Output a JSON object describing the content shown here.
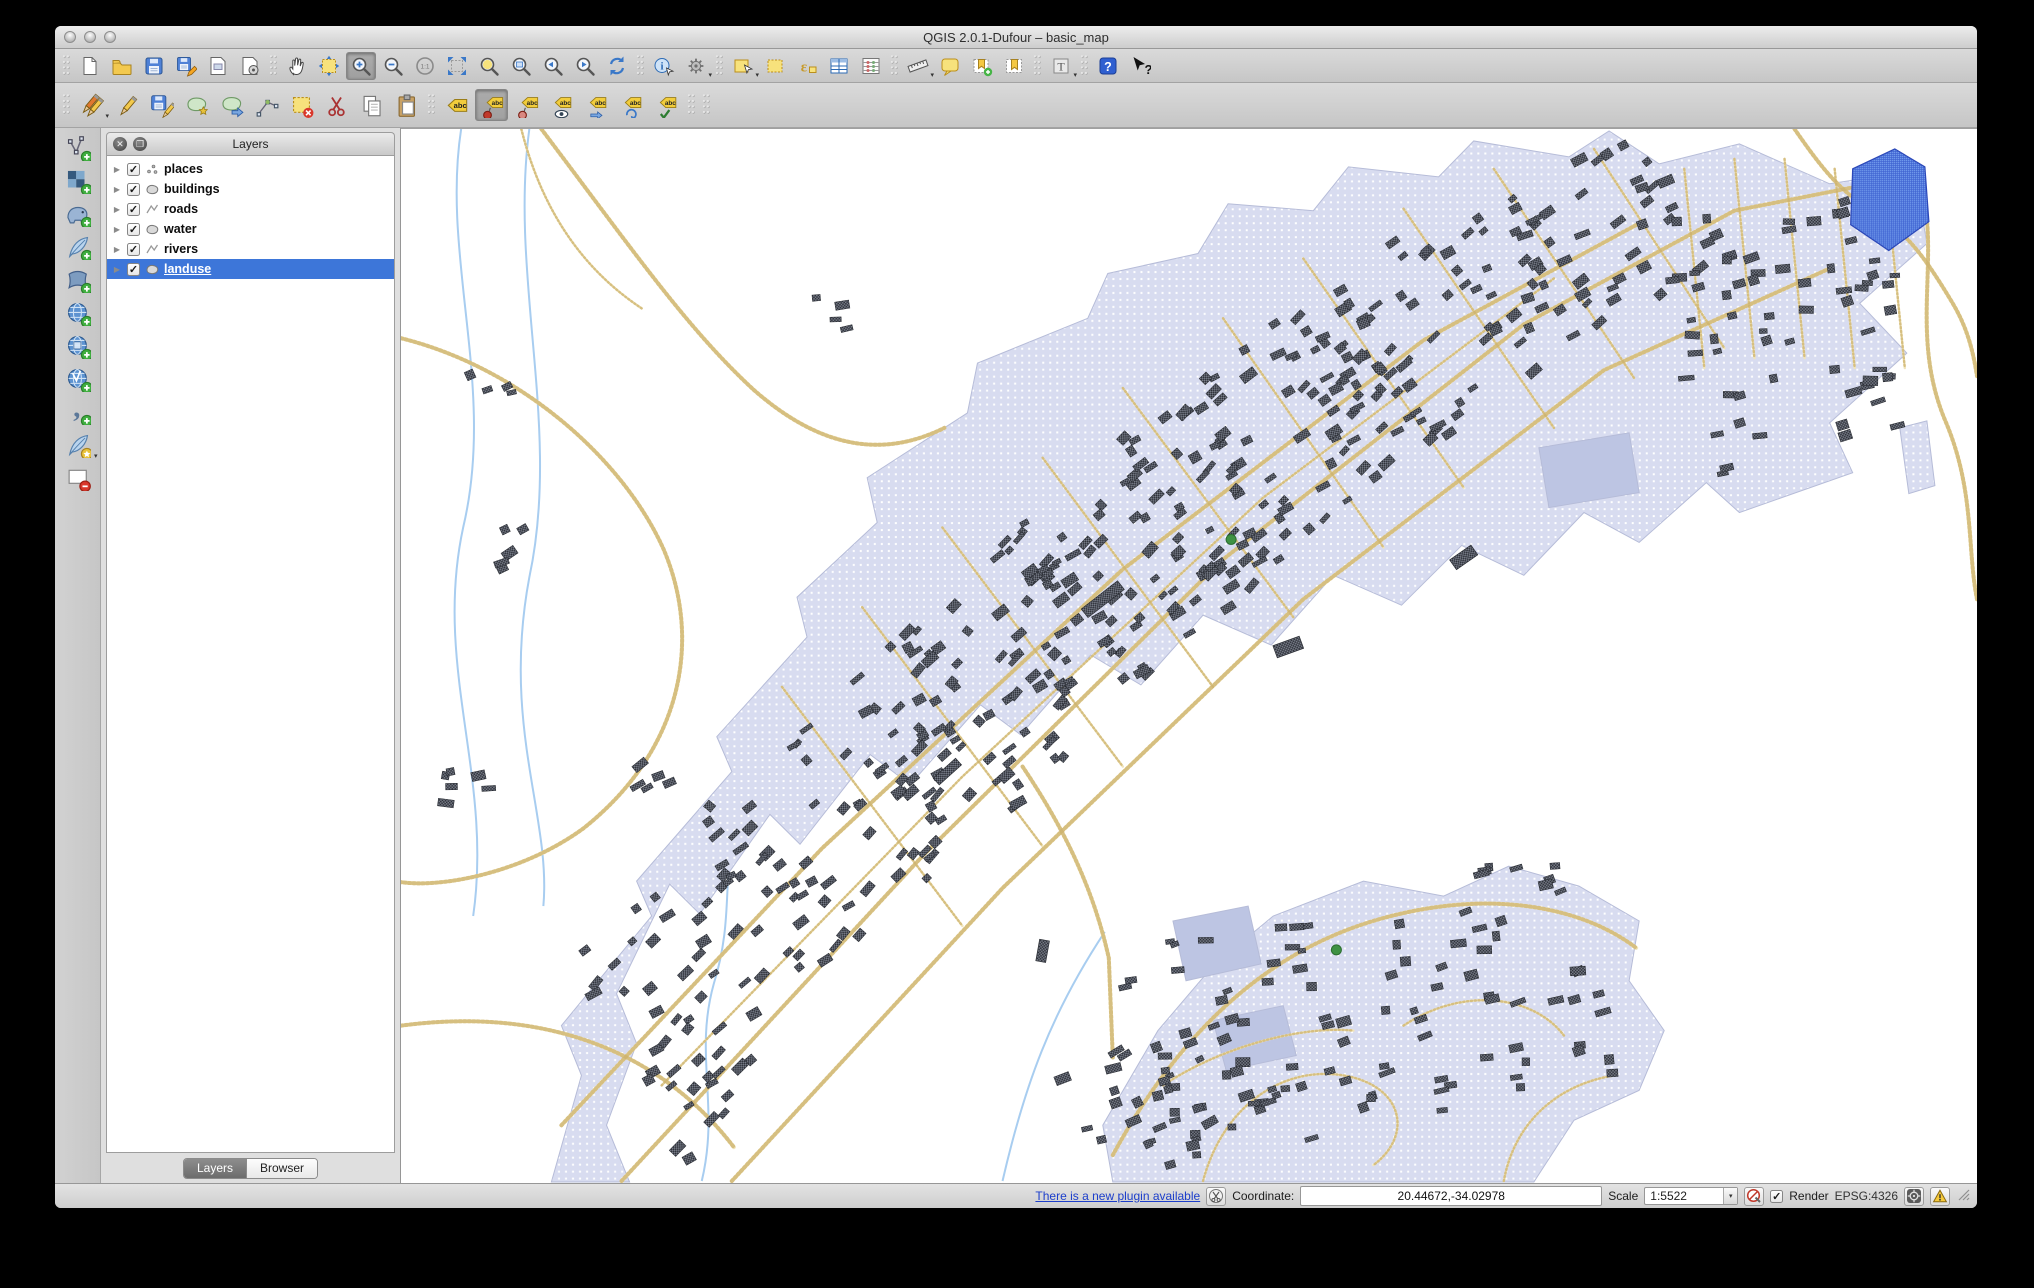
{
  "window": {
    "title": "QGIS 2.0.1-Dufour – basic_map"
  },
  "titlebar_buttons": [
    "close-button",
    "minimize-button",
    "zoom-button"
  ],
  "toolbars": {
    "main": [
      {
        "type": "grip"
      },
      {
        "name": "new-project",
        "icon": "doc"
      },
      {
        "name": "open-project",
        "icon": "folder"
      },
      {
        "name": "save-project",
        "icon": "save"
      },
      {
        "name": "save-project-as",
        "icon": "save-as"
      },
      {
        "name": "new-print-composer",
        "icon": "composer"
      },
      {
        "name": "composer-manager",
        "icon": "composer-mgr"
      },
      {
        "type": "grip"
      },
      {
        "name": "pan-map",
        "icon": "pan"
      },
      {
        "name": "pan-to-selection",
        "icon": "pan-sel"
      },
      {
        "name": "zoom-in",
        "icon": "zoom-in",
        "pressed": true
      },
      {
        "name": "zoom-out",
        "icon": "zoom-out"
      },
      {
        "name": "zoom-native",
        "icon": "zoom-11"
      },
      {
        "name": "zoom-full",
        "icon": "zoom-full"
      },
      {
        "name": "zoom-to-selection",
        "icon": "zoom-sel"
      },
      {
        "name": "zoom-to-layer",
        "icon": "zoom-layer"
      },
      {
        "name": "zoom-last",
        "icon": "zoom-last"
      },
      {
        "name": "zoom-next",
        "icon": "zoom-next"
      },
      {
        "name": "refresh-map",
        "icon": "refresh"
      },
      {
        "type": "grip"
      },
      {
        "name": "identify-features",
        "icon": "identify"
      },
      {
        "name": "run-feature-action",
        "icon": "gear",
        "dropdown": true
      },
      {
        "type": "grip"
      },
      {
        "name": "select-features",
        "icon": "select-rect",
        "dropdown": true
      },
      {
        "name": "deselect-features",
        "icon": "deselect"
      },
      {
        "name": "select-by-expression",
        "icon": "expression"
      },
      {
        "name": "open-attribute-table",
        "icon": "attr-table"
      },
      {
        "name": "field-calculator",
        "icon": "stats"
      },
      {
        "type": "grip"
      },
      {
        "name": "measure-line",
        "icon": "measure",
        "dropdown": true
      },
      {
        "name": "map-tips",
        "icon": "maptips"
      },
      {
        "name": "new-bookmark",
        "icon": "bookmark-new"
      },
      {
        "name": "show-bookmarks",
        "icon": "bookmark-show"
      },
      {
        "type": "grip"
      },
      {
        "name": "text-annotation",
        "icon": "annotation",
        "dropdown": true
      },
      {
        "type": "grip"
      },
      {
        "name": "help-contents",
        "icon": "help"
      },
      {
        "name": "whats-this",
        "icon": "whatsthis"
      }
    ],
    "edit": [
      {
        "type": "grip"
      },
      {
        "name": "current-edits",
        "icon": "edits-current",
        "dropdown": true
      },
      {
        "name": "toggle-editing",
        "icon": "edit-toggle"
      },
      {
        "name": "save-layer-edits",
        "icon": "edits-save"
      },
      {
        "name": "add-feature",
        "icon": "feat-add"
      },
      {
        "name": "move-feature",
        "icon": "feat-move"
      },
      {
        "name": "node-tool",
        "icon": "node"
      },
      {
        "name": "delete-selected",
        "icon": "del-sel"
      },
      {
        "name": "cut-features",
        "icon": "cut"
      },
      {
        "name": "copy-features",
        "icon": "copy"
      },
      {
        "name": "paste-features",
        "icon": "paste"
      },
      {
        "type": "grip"
      },
      {
        "name": "layer-labeling-options",
        "icon": "label-abc"
      },
      {
        "name": "pin-unpin-labels",
        "icon": "label-pin",
        "pressed": true
      },
      {
        "name": "highlight-pinned-labels",
        "icon": "label-pin2"
      },
      {
        "name": "show-hide-labels",
        "icon": "label-eye"
      },
      {
        "name": "move-label",
        "icon": "label-move"
      },
      {
        "name": "rotate-label",
        "icon": "label-rotate"
      },
      {
        "name": "change-label-properties",
        "icon": "label-props"
      },
      {
        "type": "grip"
      },
      {
        "type": "grip"
      }
    ],
    "side": [
      {
        "name": "add-vector-layer",
        "icon": "vector"
      },
      {
        "name": "add-raster-layer",
        "icon": "raster"
      },
      {
        "name": "add-postgis-layer",
        "icon": "postgis"
      },
      {
        "name": "add-spatialite-layer",
        "icon": "spatialite"
      },
      {
        "name": "add-mssql-layer",
        "icon": "mssql"
      },
      {
        "name": "add-wms-layer",
        "icon": "wms"
      },
      {
        "name": "add-wcs-layer",
        "icon": "wcs"
      },
      {
        "name": "add-wfs-layer",
        "icon": "wfs"
      },
      {
        "name": "add-delimited-text-layer",
        "icon": "delimited"
      },
      {
        "name": "new-spatialite-layer",
        "icon": "sl-new",
        "dropdown": true
      },
      {
        "name": "new-shapefile-layer",
        "icon": "shp-new"
      }
    ]
  },
  "layers_panel": {
    "title": "Layers",
    "header_buttons": [
      "close-panel-button",
      "float-panel-button"
    ],
    "layers": [
      {
        "label": "places",
        "geom": "point",
        "checked": true,
        "selected": false
      },
      {
        "label": "buildings",
        "geom": "polygon",
        "checked": true,
        "selected": false
      },
      {
        "label": "roads",
        "geom": "line",
        "checked": true,
        "selected": false
      },
      {
        "label": "water",
        "geom": "polygon",
        "checked": true,
        "selected": false
      },
      {
        "label": "rivers",
        "geom": "line",
        "checked": true,
        "selected": false
      },
      {
        "label": "landuse",
        "geom": "polygon",
        "checked": true,
        "selected": true
      }
    ],
    "tabs": [
      {
        "label": "Layers",
        "active": true
      },
      {
        "label": "Browser",
        "active": false
      }
    ]
  },
  "status_bar": {
    "plugin_link": "There is a new plugin available",
    "coordinate_label": "Coordinate:",
    "coordinate_value": "20.44672,-34.02978",
    "scale_label": "Scale",
    "scale_value": "1:5522",
    "render_label": "Render",
    "render_checked": true,
    "crs_label": "EPSG:4326",
    "check_glyph": "✓",
    "arrow_glyph": "▾"
  },
  "map": {
    "seed": 42,
    "colors": {
      "background": "#ffffff",
      "landuse_fill": "#d8dcf0",
      "landuse_dot": "#ffffff",
      "landuse_stroke": "#b6bcd8",
      "subpatch_fill": "#bdc5e3",
      "road_base": "#f1e5bb",
      "road_bead": "#ccb26c",
      "river": "#a8cdf0",
      "water_fill": "#7aa4f0",
      "water_line": "#3b5fd0",
      "water_stroke": "#2b48b8",
      "building_dark": "#2f323a",
      "building_light": "#767b87",
      "place_fill": "#3f9243",
      "place_stroke": "#2c6e30"
    },
    "viewbox": [
      1572,
      1058
    ],
    "landuse_polys": [
      [
        [
          150,
          1057
        ],
        [
          180,
          950
        ],
        [
          160,
          900
        ],
        [
          250,
          790
        ],
        [
          235,
          755
        ],
        [
          330,
          645
        ],
        [
          315,
          610
        ],
        [
          405,
          510
        ],
        [
          395,
          470
        ],
        [
          475,
          395
        ],
        [
          465,
          350
        ],
        [
          565,
          285
        ],
        [
          575,
          235
        ],
        [
          685,
          190
        ],
        [
          705,
          145
        ],
        [
          795,
          125
        ],
        [
          825,
          75
        ],
        [
          910,
          82
        ],
        [
          945,
          38
        ],
        [
          1035,
          48
        ],
        [
          1070,
          12
        ],
        [
          1165,
          28
        ],
        [
          1205,
          2
        ],
        [
          1255,
          35
        ],
        [
          1335,
          15
        ],
        [
          1425,
          55
        ],
        [
          1510,
          42
        ],
        [
          1522,
          115
        ],
        [
          1455,
          175
        ],
        [
          1502,
          225
        ],
        [
          1425,
          295
        ],
        [
          1448,
          345
        ],
        [
          1335,
          385
        ],
        [
          1302,
          355
        ],
        [
          1235,
          415
        ],
        [
          1180,
          385
        ],
        [
          1120,
          448
        ],
        [
          1058,
          418
        ],
        [
          998,
          478
        ],
        [
          930,
          448
        ],
        [
          868,
          518
        ],
        [
          800,
          488
        ],
        [
          738,
          558
        ],
        [
          688,
          528
        ],
        [
          618,
          608
        ],
        [
          578,
          578
        ],
        [
          508,
          658
        ],
        [
          468,
          628
        ],
        [
          398,
          718
        ],
        [
          368,
          688
        ],
        [
          298,
          788
        ],
        [
          268,
          758
        ],
        [
          215,
          868
        ],
        [
          235,
          918
        ],
        [
          205,
          1000
        ],
        [
          228,
          1057
        ]
      ],
      [
        [
          710,
          1057
        ],
        [
          700,
          1000
        ],
        [
          755,
          905
        ],
        [
          810,
          840
        ],
        [
          870,
          790
        ],
        [
          960,
          755
        ],
        [
          1040,
          770
        ],
        [
          1105,
          740
        ],
        [
          1175,
          760
        ],
        [
          1235,
          795
        ],
        [
          1225,
          855
        ],
        [
          1260,
          905
        ],
        [
          1235,
          965
        ],
        [
          1170,
          995
        ],
        [
          1130,
          1057
        ]
      ],
      [
        [
          1495,
          300
        ],
        [
          1522,
          293
        ],
        [
          1530,
          358
        ],
        [
          1504,
          366
        ]
      ]
    ],
    "subpatches": [
      [
        [
          770,
          795
        ],
        [
          845,
          780
        ],
        [
          858,
          838
        ],
        [
          783,
          855
        ]
      ],
      [
        [
          810,
          895
        ],
        [
          880,
          880
        ],
        [
          893,
          930
        ],
        [
          823,
          945
        ]
      ],
      [
        [
          1135,
          320
        ],
        [
          1225,
          305
        ],
        [
          1235,
          365
        ],
        [
          1145,
          380
        ]
      ]
    ],
    "lake": [
      [
        1448,
        40
      ],
      [
        1490,
        20
      ],
      [
        1520,
        38
      ],
      [
        1524,
        93
      ],
      [
        1484,
        122
      ],
      [
        1446,
        96
      ]
    ],
    "rivers": [
      "M60,0 C40,130 95,260 62,400 C32,540 92,650 72,790",
      "M128,0 C108,150 160,300 128,450 C100,600 150,690 142,780",
      "M300,1056 C318,980 292,930 312,858 C330,800 322,760 330,720",
      "M600,1056 C622,960 648,888 702,806"
    ],
    "roads_main": [
      "M220,1056 L520,730 L820,432 L1120,196 L1330,82 L1512,46",
      "M330,1056 L600,762 L900,472 L1200,242 L1425,140",
      "M160,1000 L420,722 L720,442 L1020,212 L1240,92",
      "M140,0 C230,120 285,200 352,262 C420,322 482,330 542,300",
      "M0,210 C120,240 222,332 262,422 C300,512 282,622 182,702 C122,746 42,762 0,756",
      "M1390,0 C1412,32 1432,60 1464,80 C1502,102 1522,132 1546,172 C1562,198 1568,222 1572,248",
      "M1512,46 C1540,120 1502,200 1540,292 C1570,362 1562,422 1572,472",
      "M620,640 C660,700 690,760 706,832 L710,932",
      "M710,1030 C780,900 870,822 980,792 C1090,762 1180,782 1232,822",
      "M0,900 C150,880 262,930 332,1022"
    ],
    "roads_minor": [
      "M380,560 L560,800",
      "M460,480 L640,720",
      "M540,400 L720,640",
      "M640,330 L810,560",
      "M720,260 L890,490",
      "M820,190 L980,420",
      "M900,130 L1060,360",
      "M1000,80 L1150,300",
      "M1090,40 L1230,250",
      "M1190,20 L1320,220",
      "M260,960 L560,650 L860,370 L1150,150",
      "M800,1056 C820,980 880,940 940,950 C1000,960 1010,1010 970,1040",
      "M1000,900 C1060,860 1130,870 1160,910",
      "M1100,1056 C1110,1000 1150,960 1210,950",
      "M760,960 C820,920 900,900 950,905",
      "M1280,40 L1300,240",
      "M1330,30 L1350,230",
      "M1380,30 L1400,230",
      "M1430,40 L1450,240",
      "M1480,40 L1500,240",
      "M120,0 C140,80 180,140 240,180"
    ],
    "building_clusters": [
      [
        320,
        830,
        130,
        95,
        48,
        -40
      ],
      [
        450,
        690,
        140,
        100,
        60,
        -40
      ],
      [
        590,
        560,
        150,
        100,
        70,
        -40
      ],
      [
        730,
        430,
        150,
        100,
        72,
        -40
      ],
      [
        880,
        310,
        150,
        100,
        72,
        -38
      ],
      [
        1030,
        200,
        150,
        95,
        64,
        -35
      ],
      [
        1170,
        125,
        140,
        80,
        50,
        -30
      ],
      [
        1385,
        205,
        115,
        135,
        66,
        -8
      ],
      [
        960,
        885,
        240,
        115,
        105,
        -12
      ],
      [
        745,
        985,
        80,
        70,
        24,
        -20
      ],
      [
        300,
        960,
        60,
        60,
        16,
        -40
      ],
      [
        115,
        420,
        25,
        40,
        5,
        -30
      ],
      [
        90,
        255,
        20,
        25,
        4,
        -20
      ],
      [
        255,
        645,
        25,
        25,
        5,
        -30
      ],
      [
        425,
        185,
        20,
        20,
        4,
        -10
      ],
      [
        62,
        662,
        30,
        18,
        6,
        0
      ]
    ],
    "big_buildings": [
      [
        700,
        472,
        46,
        11,
        -38
      ],
      [
        545,
        645,
        30,
        9,
        -42
      ],
      [
        885,
        520,
        28,
        13,
        -20
      ],
      [
        1060,
        430,
        26,
        12,
        -35
      ],
      [
        640,
        825,
        22,
        10,
        -80
      ]
    ],
    "places": [
      [
        828,
        412
      ],
      [
        933,
        824
      ]
    ]
  }
}
